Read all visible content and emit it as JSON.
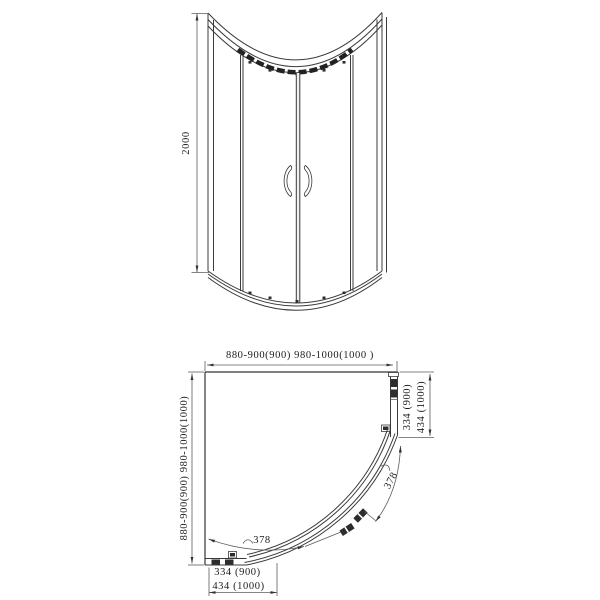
{
  "drawing": {
    "subject": "quadrant-shower-enclosure-technical-drawing",
    "colors": {
      "background": "#ffffff",
      "line": "#3b3b3b",
      "text": "#1c1c1c"
    }
  },
  "front_view": {
    "height_dim": "2000"
  },
  "plan_view": {
    "top_width_dim": "880-900(900)  980-1000(1000 )",
    "left_height_dim": "880-900(900)  980-1000(1000)",
    "right_offset_dims": [
      "334 (900)",
      "434 (1000)"
    ],
    "bottom_offset_dims": [
      "334 (900)",
      "434 (1000)"
    ],
    "door_arc_dim_bottom": "378",
    "door_arc_dim_right": "378"
  }
}
